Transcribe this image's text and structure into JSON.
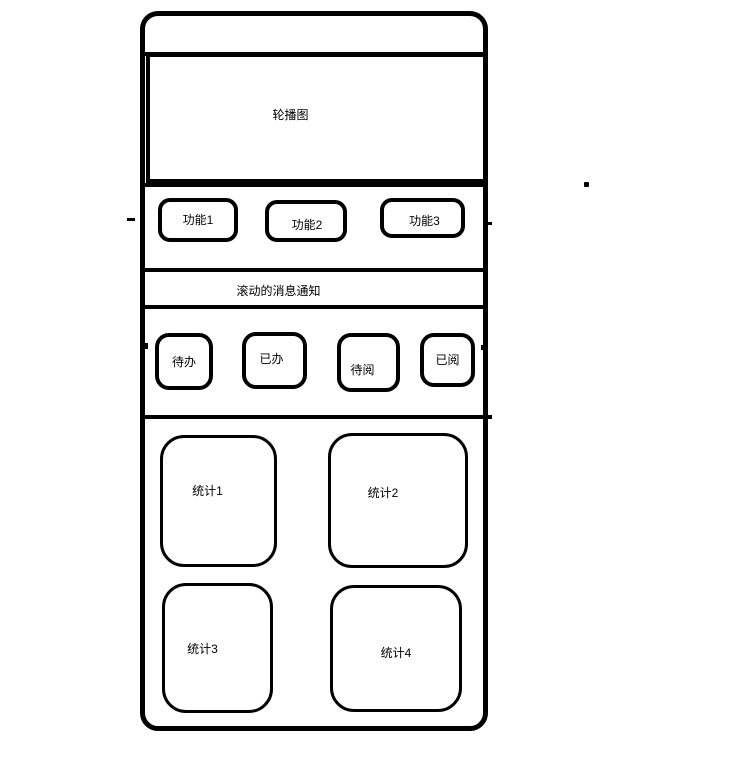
{
  "colors": {
    "line": "#000000",
    "background": "#ffffff",
    "text": "#000000"
  },
  "topbar": {},
  "carousel": {
    "label": "轮播图"
  },
  "functions": {
    "buttons": [
      {
        "label": "功能1"
      },
      {
        "label": "功能2"
      },
      {
        "label": "功能3"
      }
    ]
  },
  "notice": {
    "label": "滚动的消息通知"
  },
  "tasks": {
    "buttons": [
      {
        "label": "待办"
      },
      {
        "label": "已办"
      },
      {
        "label": "待阅"
      },
      {
        "label": "已阅"
      }
    ]
  },
  "stats": {
    "boxes": [
      {
        "label": "统计1"
      },
      {
        "label": "统计2"
      },
      {
        "label": "统计3"
      },
      {
        "label": "统计4"
      }
    ]
  }
}
